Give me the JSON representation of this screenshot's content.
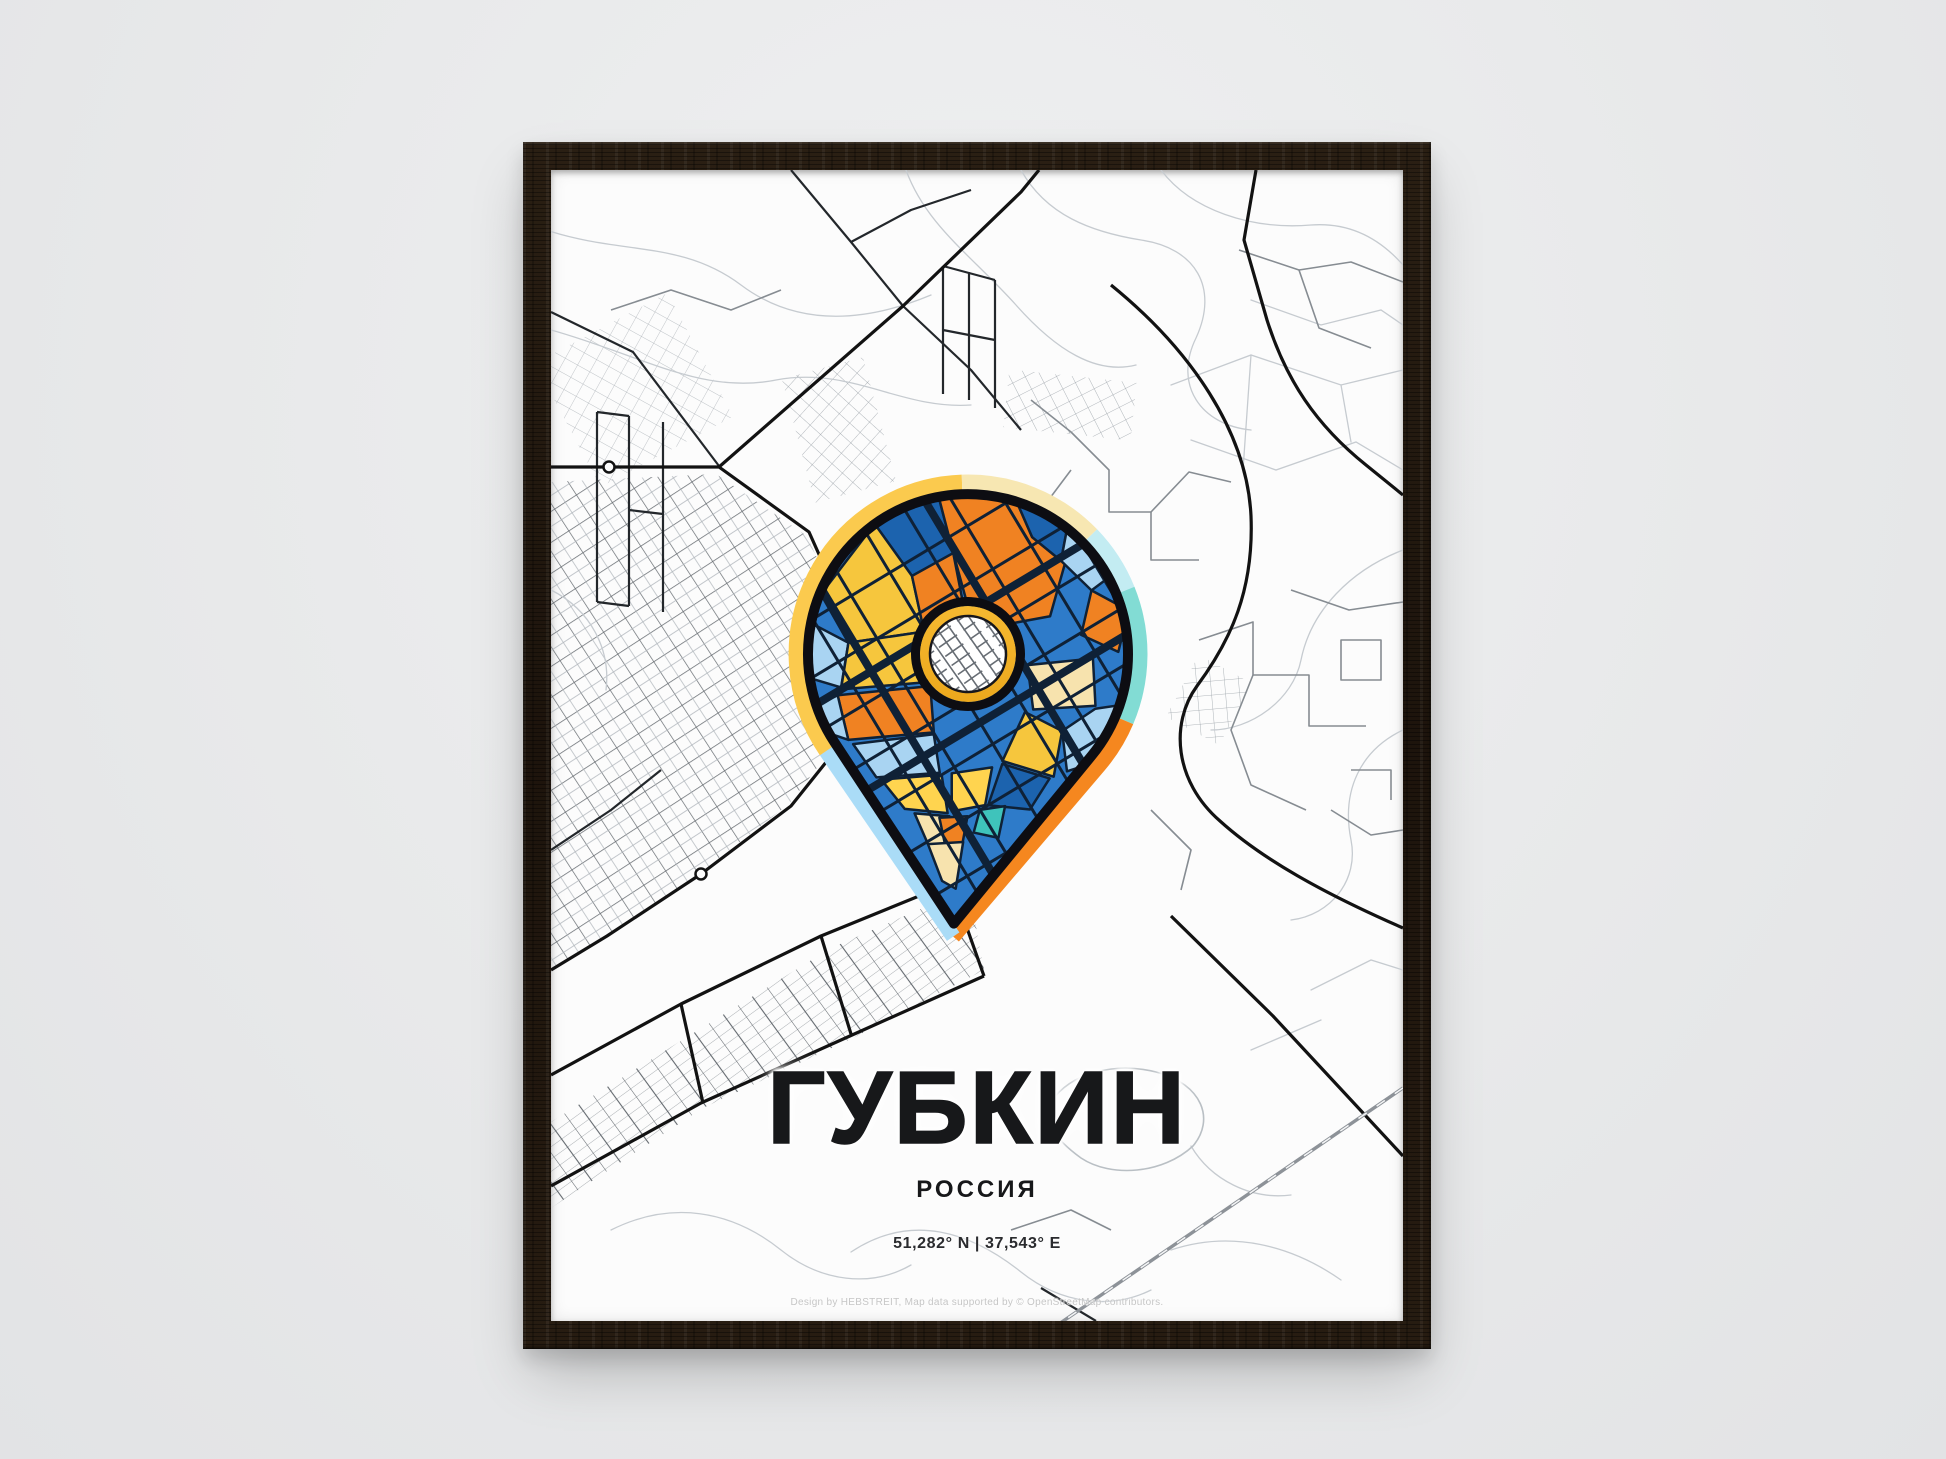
{
  "poster": {
    "title": "ГУБКИН",
    "subtitle": "РОССИЯ",
    "coordinates": "51,282° N | 37,543° E",
    "attribution": "Design by HEBSTREIT, Map data supported by © OpenStreetMap contributors."
  },
  "colors": {
    "wall": "#e9eaeb",
    "frame-wood": "#231910",
    "paper": "#fcfcfc",
    "text": "#17181a",
    "attribution-text": "#c6c6c6",
    "map-line-light": "#c6cbd0",
    "map-line-medium": "#868c92",
    "map-road-dark": "#23272b",
    "map-road-black": "#121212",
    "railway-gray": "#8d9298",
    "pin-outline": "#0d0d12",
    "pin-base-blue": "#2e7bc9",
    "pin-dark-blue": "#1c63ae",
    "pin-light-blue": "#a9d4f2",
    "pin-orange": "#f08222",
    "pin-yellow": "#f6c63d",
    "pin-bright-yellow": "#ffd44f",
    "pin-cream": "#f7e3ae",
    "pin-teal": "#3fc3bb",
    "pin-street": "#0f2136",
    "ring-gold": "#f6bb2e",
    "ring-white": "#ffffff",
    "rim-yellow": "#fbca4e",
    "rim-cream": "#f7e7b2",
    "rim-cyan": "#c3ecf2",
    "rim-teal": "#82dcd4",
    "rim-orange": "#f5871f",
    "rim-light-blue": "#aadcf7"
  }
}
